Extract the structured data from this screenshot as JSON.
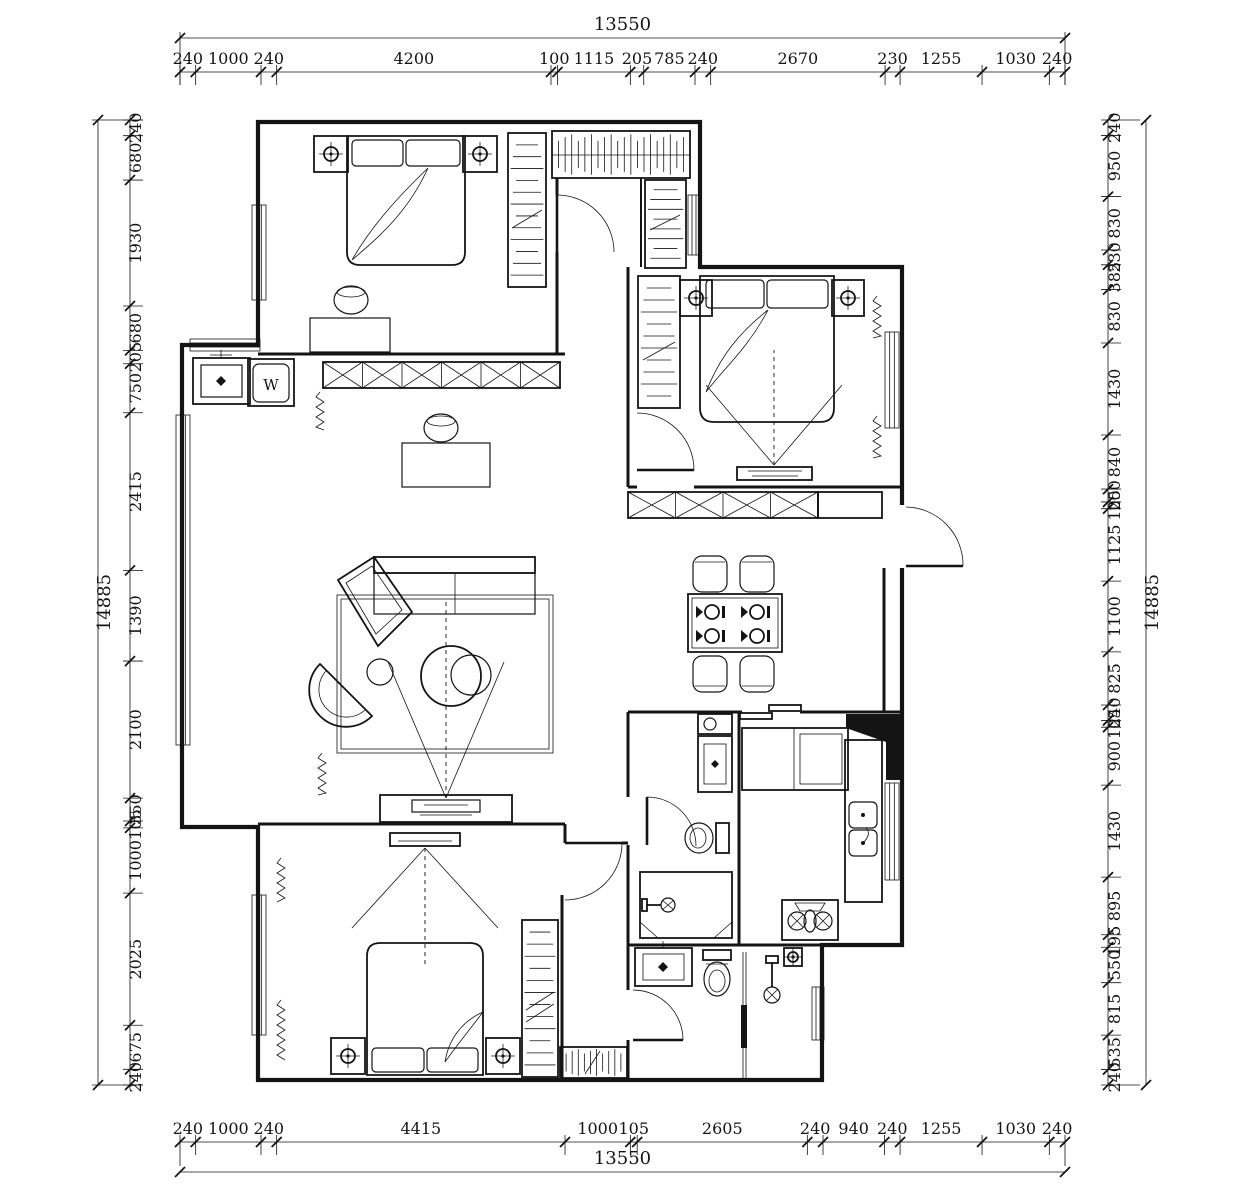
{
  "plan": {
    "washer_label": "W"
  },
  "colors": {
    "line": "#141414",
    "bg": "#ffffff"
  },
  "dimensions": {
    "top": {
      "overall": "13550",
      "segments": [
        "240",
        "1000",
        "240",
        "4200",
        "100",
        "1115",
        "205",
        "785",
        "240",
        "2670",
        "230",
        "1255",
        "1030",
        "240"
      ]
    },
    "bottom": {
      "overall": "13550",
      "segments": [
        "240",
        "1000",
        "240",
        "4415",
        "1000",
        "105",
        "2605",
        "240",
        "940",
        "240",
        "1255",
        "1030",
        "240"
      ]
    },
    "left": {
      "overall": "14885",
      "segments": [
        "240",
        "680",
        "1930",
        "680",
        "205",
        "750",
        "2415",
        "1390",
        "2100",
        "350",
        "105",
        "1000",
        "2025",
        "675",
        "240"
      ]
    },
    "right": {
      "overall": "14885",
      "segments": [
        "240",
        "950",
        "830",
        "230",
        "385",
        "830",
        "1430",
        "840",
        "200",
        "105",
        "1125",
        "1100",
        "825",
        "240",
        "105",
        "900",
        "1430",
        "895",
        "195",
        "550",
        "815",
        "535",
        "240"
      ]
    }
  }
}
